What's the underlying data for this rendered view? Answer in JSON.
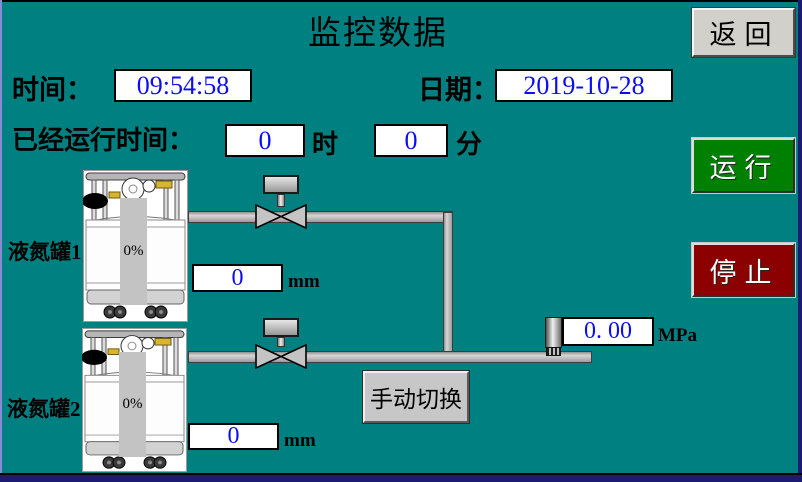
{
  "screen": {
    "title": "监控数据"
  },
  "datetime": {
    "time_label": "时间：",
    "time_value": "09:54:58",
    "date_label": "日期：",
    "date_value": "2019-10-28"
  },
  "runtime": {
    "label": "已经运行时间：",
    "hours": "0",
    "hours_unit": "时",
    "minutes": "0",
    "minutes_unit": "分"
  },
  "tanks": [
    {
      "name": "液氮罐1",
      "level_percent": "0%",
      "level_mm": "0",
      "mm_unit": "mm"
    },
    {
      "name": "液氮罐2",
      "level_percent": "0%",
      "level_mm": "0",
      "mm_unit": "mm"
    }
  ],
  "pressure": {
    "value": "0. 00",
    "unit": "MPa"
  },
  "buttons": {
    "back": "返回",
    "run": "运行",
    "stop": "停止",
    "manual": "手动切换"
  },
  "icons": {
    "valve": "bowtie-pipe-valve",
    "pressure_sensor": "cylinder-sensor",
    "tank": "liquid-nitrogen-dewar-illustration"
  },
  "colors": {
    "background": "#008080",
    "value_text": "#0d0df0",
    "run_button": "#008000",
    "stop_button": "#8b0000",
    "gray_button": "#d2d0ca",
    "pipe": "#b9b9b9",
    "frame_blue": "#1b1b72"
  }
}
